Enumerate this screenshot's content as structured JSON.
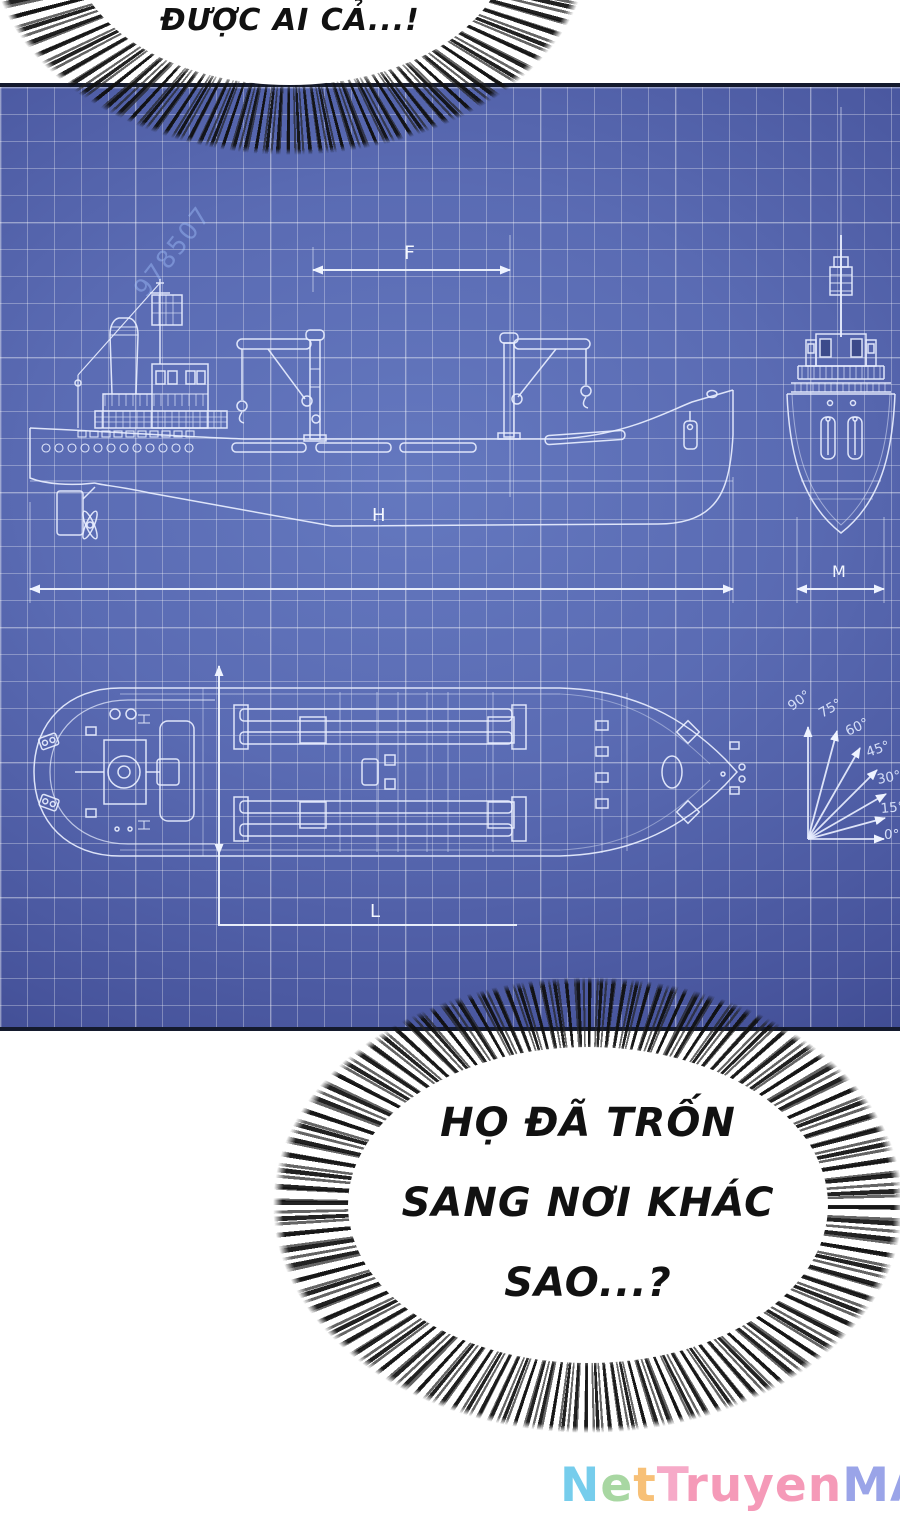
{
  "comic": {
    "top_bubble": {
      "text": "ĐƯỢC AI CẢ...!"
    },
    "bottom_bubble": {
      "lines": [
        "HỌ ĐÃ TRỐN",
        "SANG NƠI KHÁC",
        "SAO...?"
      ]
    }
  },
  "blueprint": {
    "dimension_labels": {
      "f": "F",
      "h": "H",
      "m": "M",
      "l": "L"
    },
    "protractor": {
      "angles": [
        "90°",
        "75°",
        "60°",
        "45°",
        "30°",
        "15°",
        "0°"
      ]
    },
    "stock_id_watermark": "978507",
    "colors": {
      "background_center": "#6478bf",
      "background_edge": "#333d7c",
      "line": "#edf2ff",
      "border": "#141a2d"
    }
  },
  "site_watermark": {
    "text": "NetTruyenMAX",
    "letters": [
      {
        "ch": "N",
        "color": "#76cdec"
      },
      {
        "ch": "e",
        "color": "#a8d7a2"
      },
      {
        "ch": "t",
        "color": "#f7c077"
      },
      {
        "ch": "T",
        "color": "#f6aac8"
      },
      {
        "ch": "r",
        "color": "#f59ab8"
      },
      {
        "ch": "u",
        "color": "#f59ab8"
      },
      {
        "ch": "y",
        "color": "#f59ab8"
      },
      {
        "ch": "e",
        "color": "#f59ab8"
      },
      {
        "ch": "n",
        "color": "#f59ab8"
      },
      {
        "ch": "M",
        "color": "#9aa4e8"
      },
      {
        "ch": "A",
        "color": "#9aa4e8"
      },
      {
        "ch": "X",
        "color": "#9aa4e8"
      }
    ]
  }
}
